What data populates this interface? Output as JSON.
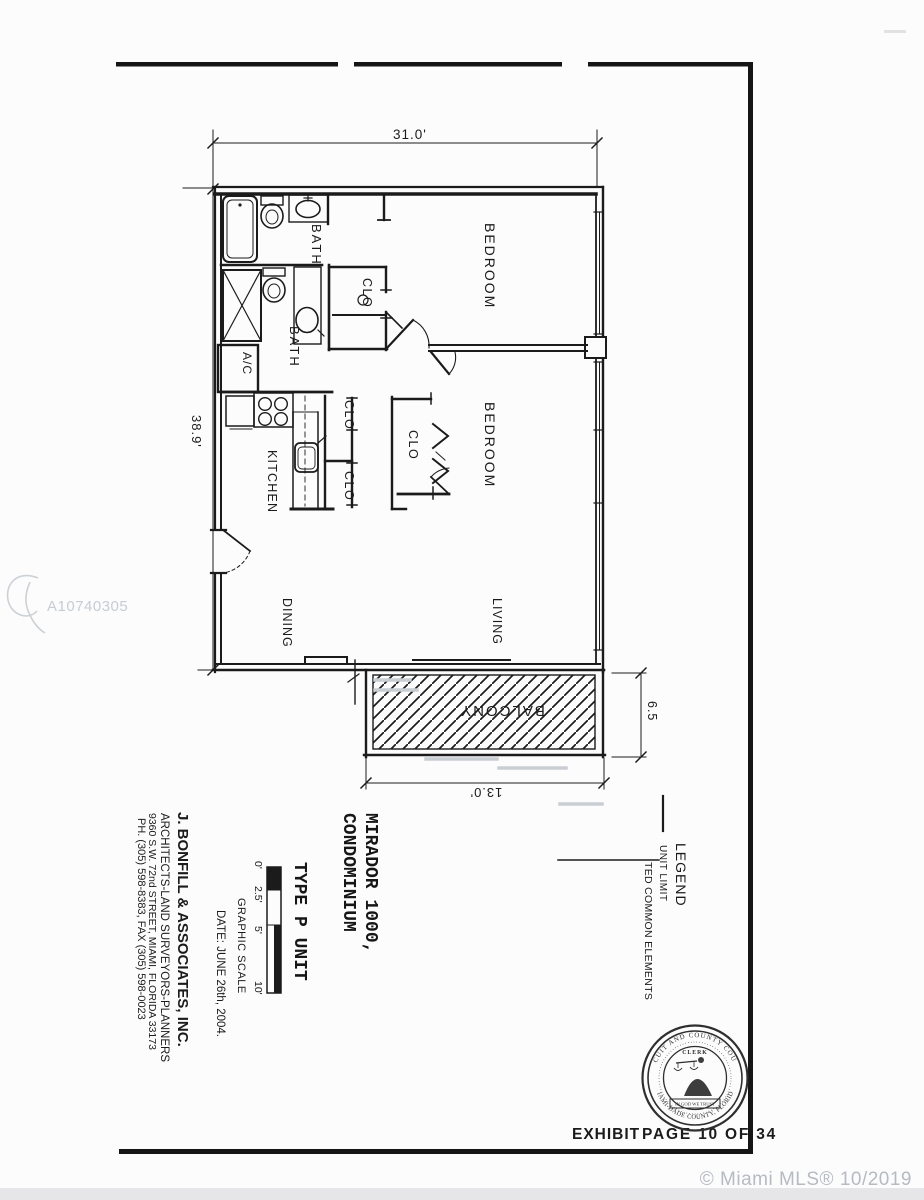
{
  "photo": {
    "watermark_id": "A10740305",
    "copyright": "© Miami MLS® 10/2019"
  },
  "footer": {
    "exhibit": "EXHIBIT",
    "page": "PAGE 10 OF 34"
  },
  "seal": {
    "ring_top": "CIRCUIT AND COUNTY COURTS",
    "ring_bottom": "MIAMI-DADE COUNTY, FLORIDA",
    "clerk": "CLERK",
    "motto": "IN GOD WE TRUST"
  },
  "plan": {
    "labels": {
      "bedroom": "BEDROOM",
      "bath": "BATH",
      "clo": "CLO",
      "kitchen": "KITCHEN",
      "dining": "DINING",
      "living": "LIVING",
      "balcony": "BALCONY",
      "ac": "A/C"
    },
    "dimensions": {
      "top": "31.0'",
      "left": "38.9'",
      "balcony_depth": "6.5",
      "balcony_width": "13.0'"
    }
  },
  "legend": {
    "title": "LEGEND",
    "unit_limit": "UNIT LIMIT",
    "common_elements": "TED COMMON ELEMENTS"
  },
  "title_block": {
    "project_line1": "MIRADOR 1000,",
    "project_line2": "CONDOMINIUM",
    "unit_type": "TYPE P UNIT",
    "graphic_scale": {
      "title": "GRAPHIC SCALE",
      "ticks": [
        "0'",
        "2.5'",
        "5'",
        "10'"
      ]
    },
    "firm_line1": "J. BONFILL & ASSOCIATES, INC.",
    "firm_line2": "ARCHITECTS-LAND SURVEYORS-PLANNERS",
    "firm_line3": "9360 S.W. 72nd STREET, MIAMI, FLORIDA 33173",
    "firm_line4": "PH. (305) 598-8383, FAX (305) 598-0023",
    "date": "DATE: JUNE 26th, 2004."
  },
  "colors": {
    "ink": "#1b1b1b",
    "paper": "#fcfcfd",
    "faded_marks": "#c9ced3",
    "watermark": "#c6ccd2",
    "copyright": "#b6bbc1",
    "bottom_strip": "#e6e6e8"
  }
}
